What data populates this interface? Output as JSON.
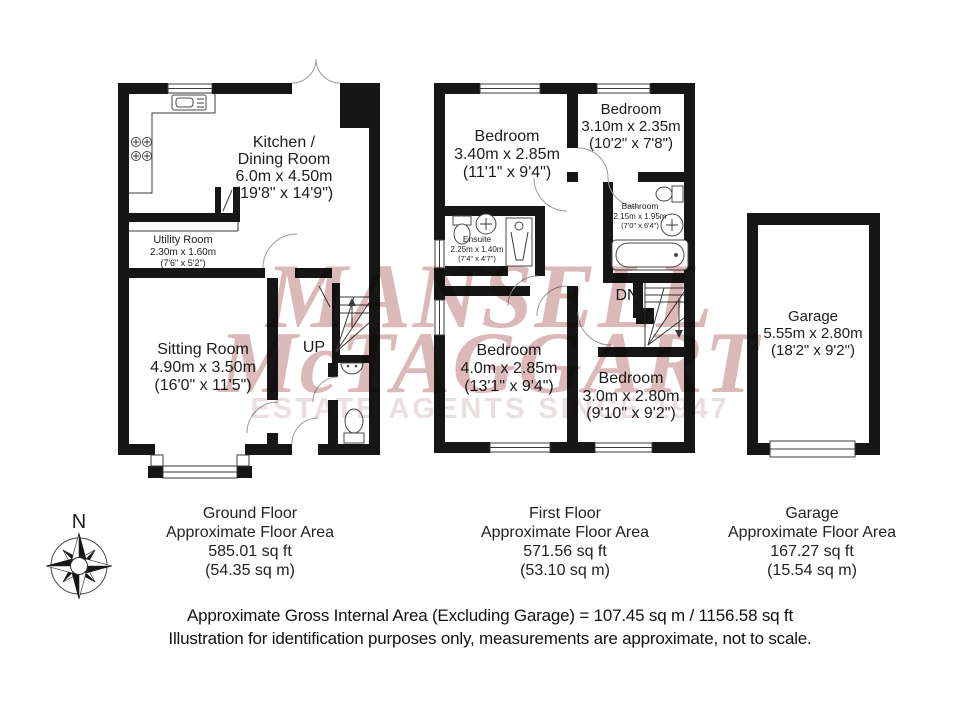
{
  "watermark": {
    "line1": "MANSELL",
    "line2": "McTAGGART",
    "line3": "ESTATE AGENTS SINCE 1947",
    "pink": "#dcb9b9",
    "gray": "#eadfdf"
  },
  "compass": {
    "north_label": "N"
  },
  "ground_floor": {
    "rooms": {
      "kitchen_dining": {
        "line1": "Kitchen /",
        "line2": "Dining Room",
        "metric": "6.0m x 4.50m",
        "imperial": "(19'8\" x 14'9\")"
      },
      "utility": {
        "name": "Utility Room",
        "metric": "2.30m x 1.60m",
        "imperial": "(7'6\" x 5'2\")"
      },
      "sitting": {
        "name": "Sitting Room",
        "metric": "4.90m x 3.50m",
        "imperial": "(16'0\" x 11'5\")"
      }
    },
    "stairs_label": "UP",
    "caption": {
      "title": "Ground Floor",
      "subtitle": "Approximate Floor Area",
      "area_ft": "585.01 sq ft",
      "area_m": "(54.35 sq m)"
    }
  },
  "first_floor": {
    "rooms": {
      "bedroom1": {
        "name": "Bedroom",
        "metric": "3.40m x 2.85m",
        "imperial": "(11'1\" x 9'4\")"
      },
      "bedroom2": {
        "name": "Bedroom",
        "metric": "3.10m x 2.35m",
        "imperial": "(10'2\" x 7'8\")"
      },
      "bathroom": {
        "name": "Bathroom",
        "metric": "2.15m x 1.95m",
        "imperial": "(7'0\" x 6'4\")"
      },
      "ensuite": {
        "name": "Ensuite",
        "metric": "2.25m x 1.40m",
        "imperial": "(7'4\" x 4'7\")"
      },
      "bedroom3": {
        "name": "Bedroom",
        "metric": "4.0m x 2.85m",
        "imperial": "(13'1\" x 9'4\")"
      },
      "bedroom4": {
        "name": "Bedroom",
        "metric": "3.0m x 2.80m",
        "imperial": "(9'10\" x 9'2\")"
      }
    },
    "stairs_label": "DN",
    "caption": {
      "title": "First Floor",
      "subtitle": "Approximate Floor Area",
      "area_ft": "571.56 sq ft",
      "area_m": "(53.10 sq m)"
    }
  },
  "garage": {
    "room": {
      "name": "Garage",
      "metric": "5.55m x 2.80m",
      "imperial": "(18'2\" x 9'2\")"
    },
    "caption": {
      "title": "Garage",
      "subtitle": "Approximate Floor Area",
      "area_ft": "167.27 sq ft",
      "area_m": "(15.54 sq m)"
    }
  },
  "footer": {
    "line1": "Approximate Gross Internal Area (Excluding Garage) = 107.45 sq m / 1156.58 sq ft",
    "line2": "Illustration for identification purposes only, measurements are approximate, not to scale."
  },
  "colors": {
    "wall": "#161616"
  }
}
